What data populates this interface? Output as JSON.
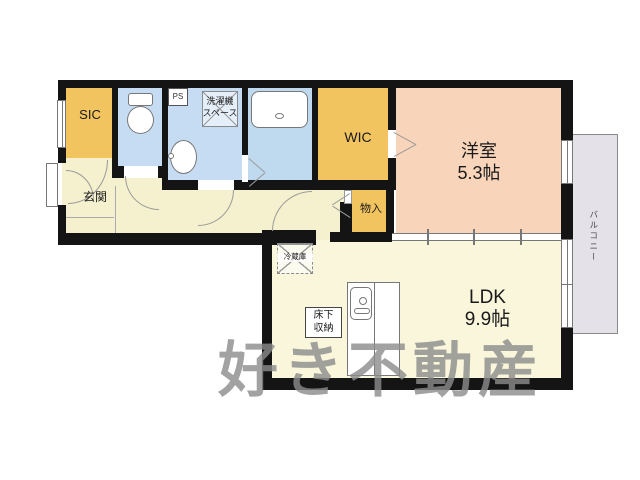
{
  "floorplan": {
    "labels": {
      "sic": "SIC",
      "genkan": "玄関",
      "ps": "PS",
      "washer_line1": "洗濯機",
      "washer_line2": "スペース",
      "wic": "WIC",
      "bedroom_name": "洋室",
      "bedroom_size": "5.3帖",
      "storage": "物入",
      "fridge": "冷蔵庫",
      "underfloor_line1": "床下",
      "underfloor_line2": "収納",
      "ldk_name": "LDK",
      "ldk_size": "9.9帖",
      "balcony": "バルコニー",
      "watermark": "好き不動産"
    },
    "colors": {
      "wall": "#141414",
      "hall_floor": "#f5f0cd",
      "ldk_floor": "#f9f6db",
      "bedroom_floor": "#f8d5ba",
      "closet_yellow": "#f2c45f",
      "wet_area_blue": "#c6dcf2",
      "bath_blue": "#bfd9ee",
      "balcony_gray": "#e4e2e8",
      "watermark_gray": "#8c8c8c"
    }
  }
}
